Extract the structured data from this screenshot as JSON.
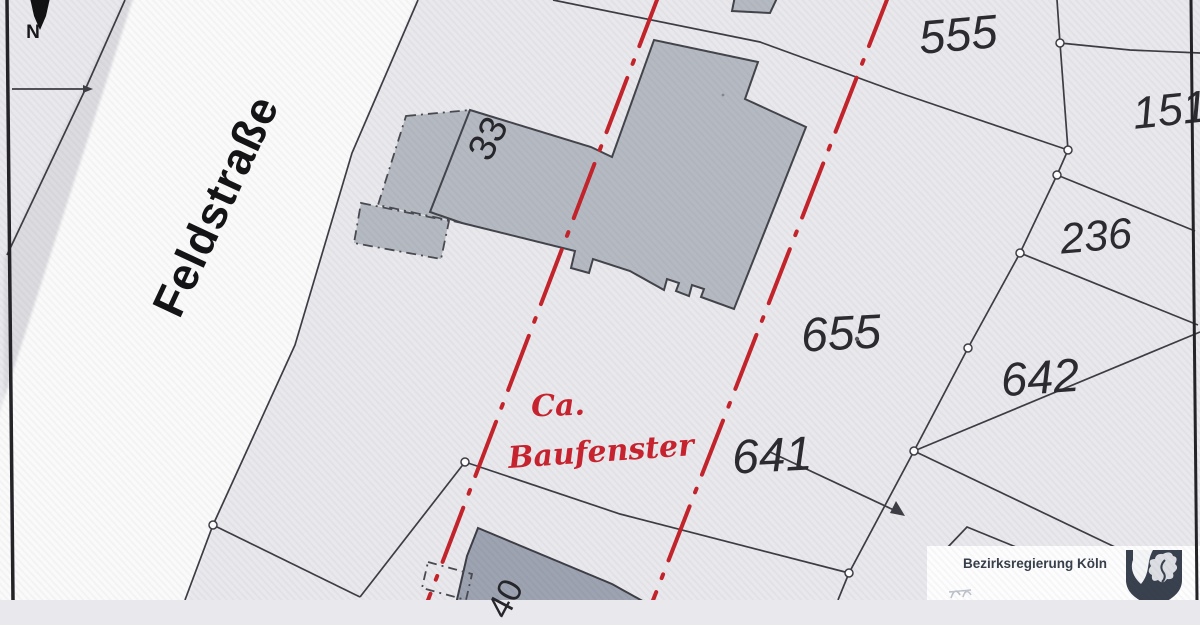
{
  "map": {
    "north_label": "N",
    "street": {
      "name": "Feldstraße"
    },
    "house_numbers": {
      "b33": "33",
      "b_bottom": "40"
    },
    "parcels": {
      "p555": "555",
      "p151": "151",
      "p236": "236",
      "p655": "655",
      "p642": "642",
      "p641": "641"
    },
    "annotation": {
      "line1": "Ca.",
      "line2": "Baufenster"
    },
    "logo": {
      "agency": "Bezirksregierung Köln"
    },
    "colors": {
      "paper": "#e9e8ec",
      "street_fill": "#fafafa",
      "street_shoulder": "#dcdbe0",
      "boundary": "#3d3d45",
      "building_fill": "#b5bac2",
      "building_fill_dark": "#9da3b0",
      "building_stroke": "#44444c",
      "red_line": "#c4242b",
      "handwriting": "#c8232e",
      "frame": "#232328",
      "shield": "#39414f"
    }
  }
}
